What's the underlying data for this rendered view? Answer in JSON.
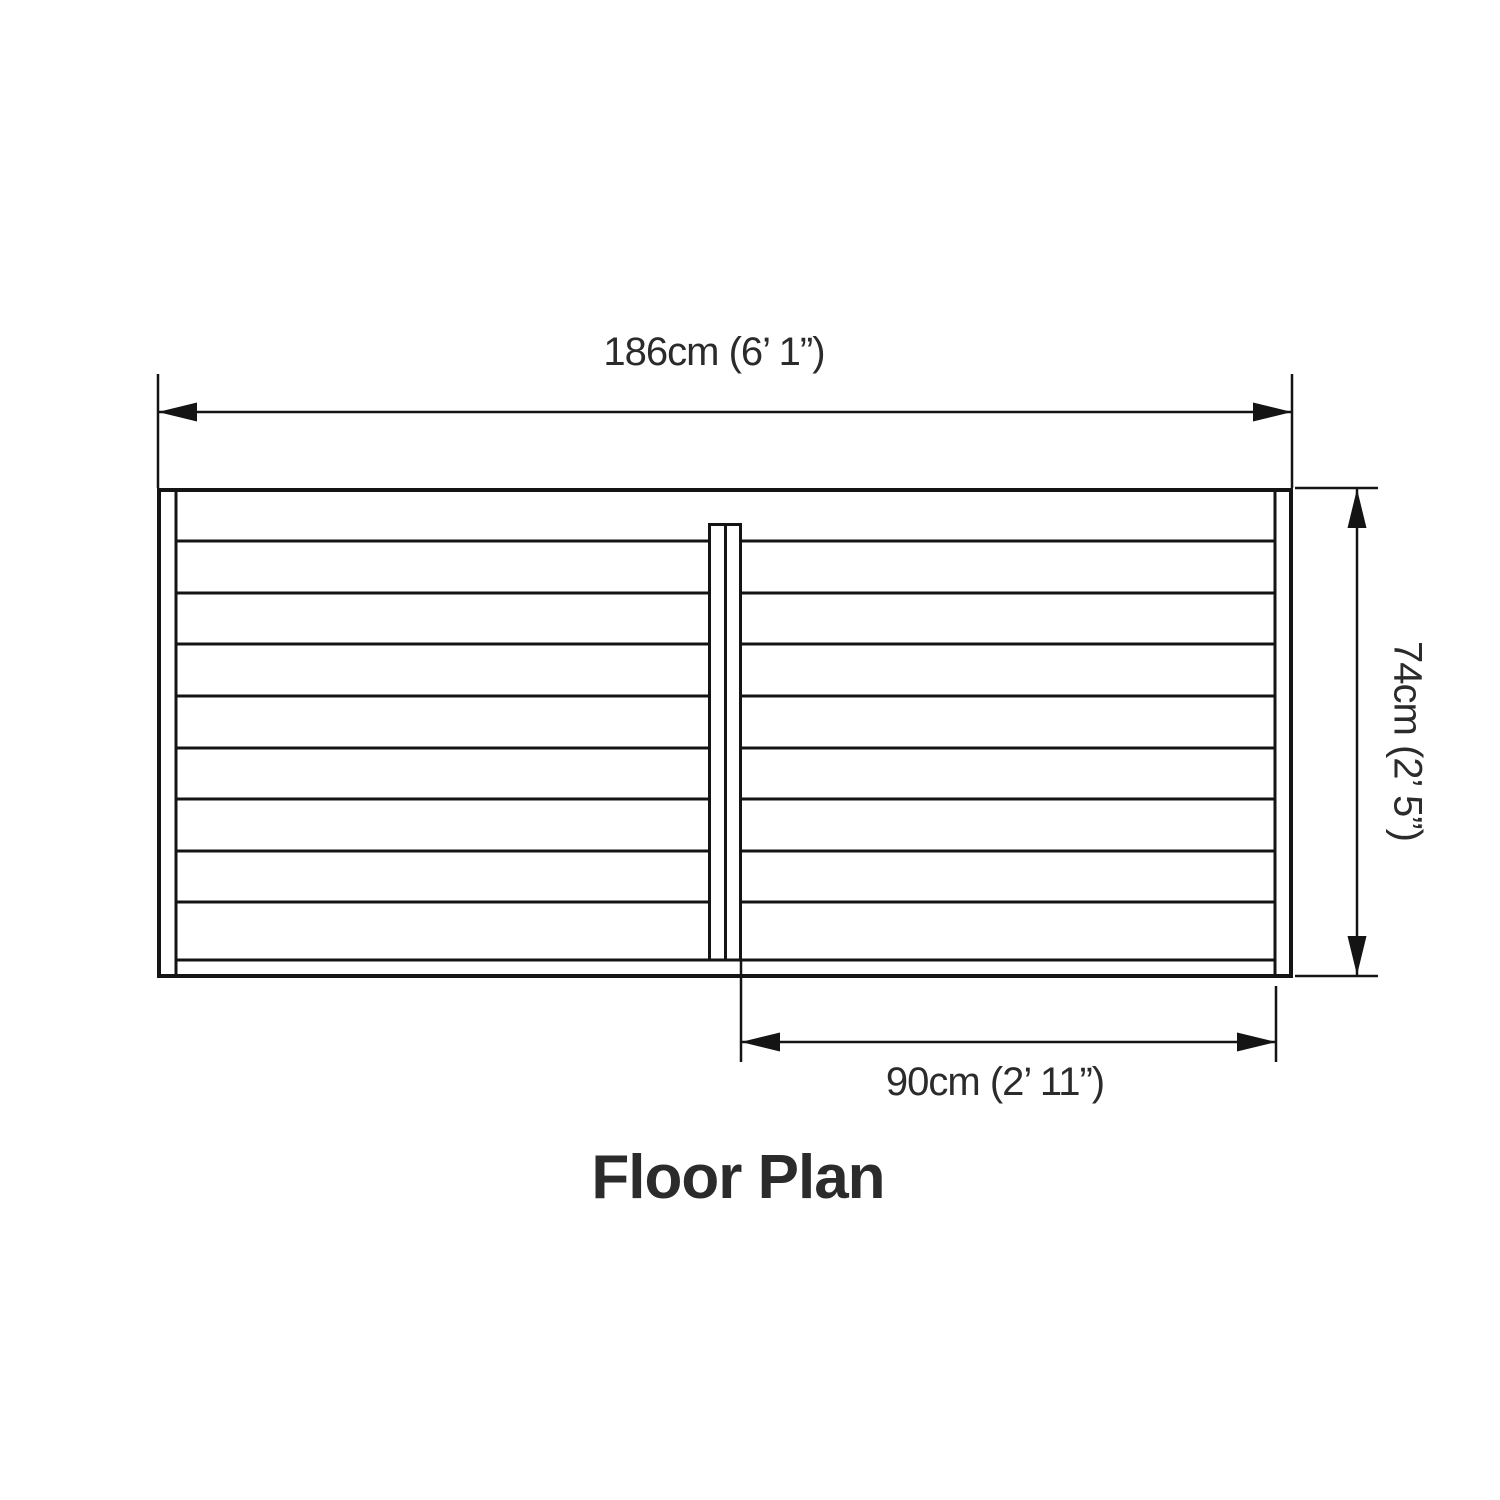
{
  "title": "Floor Plan",
  "dimensions": {
    "width": {
      "label": "186cm (6’ 1”)",
      "value_cm": "186"
    },
    "height": {
      "label": "74cm (2’ 5”)",
      "value_cm": "74"
    },
    "door": {
      "label": "90cm (2’ 11”)",
      "value_cm": "90"
    }
  },
  "colors": {
    "line": "#141414",
    "text": "#2b2b2b",
    "hatch_line": "#4faf9f",
    "hatch_bg": "#f7fcfb"
  }
}
